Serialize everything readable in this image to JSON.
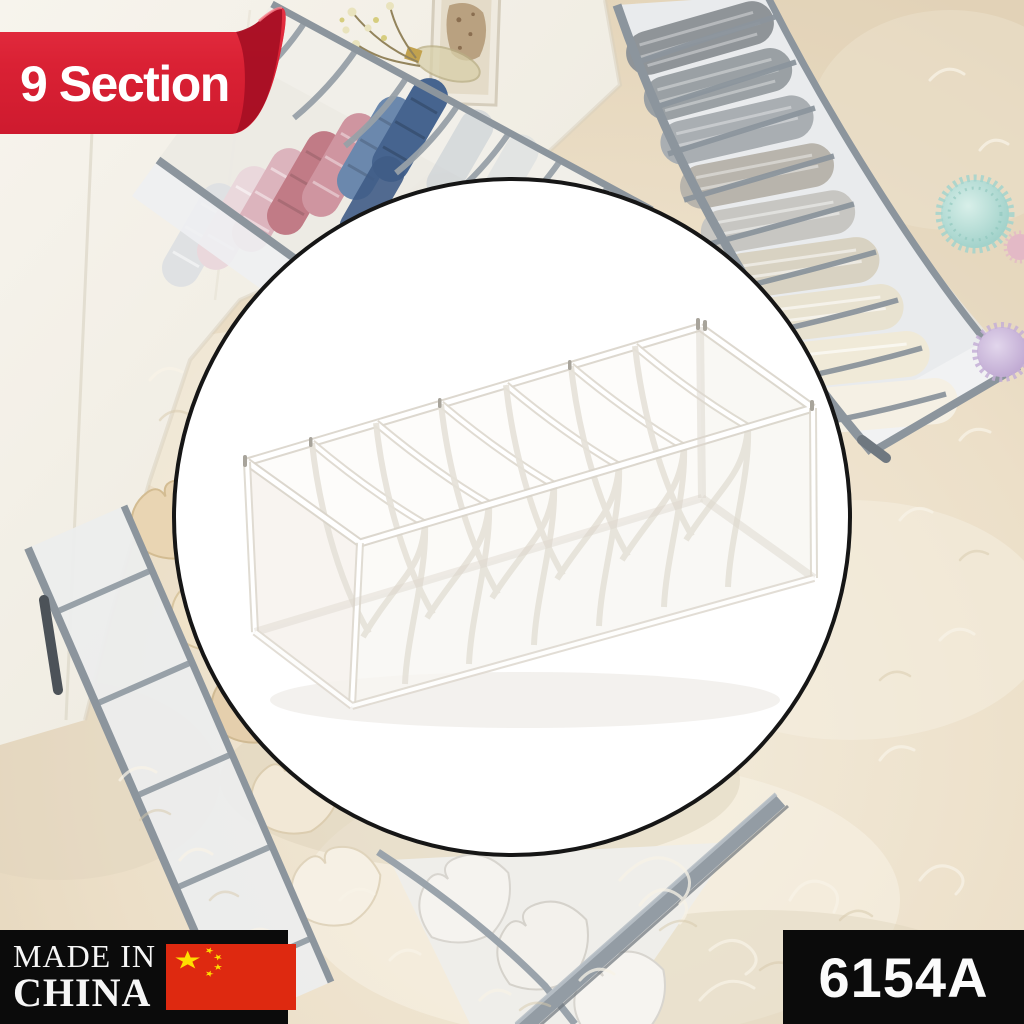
{
  "image_type": "e-commerce product photo",
  "banner": {
    "label": "9 Section",
    "text_color": "#ffffff",
    "ribbon_color": "#da2134",
    "ribbon_fold_color": "#a60f24"
  },
  "inset": {
    "shape": "circle",
    "background": "#ffffff",
    "border_color": "#161616",
    "product_name": "white-mesh-drawer-organizer",
    "compartments_visible": 7,
    "tape_color": "#f2efe9"
  },
  "made_in_badge": {
    "line1": "MADE IN",
    "line2": "CHINA",
    "background": "#0b0b0b",
    "text_color": "#f6f6f6",
    "flag": {
      "name": "china-flag",
      "field": "#de2910",
      "stars": "#ffde00"
    }
  },
  "code_badge": {
    "label": "6154A",
    "background": "#0b0b0b",
    "text_color": "#fbfbfb"
  },
  "scene": {
    "rug_color": "#ecdfc8",
    "wall_color": "#f4f1e9",
    "trim_color": "#8c959d",
    "items": [
      {
        "name": "drawer-organizer-with-rolled-clothes",
        "position": "top-left",
        "contents_colors": [
          "#dfe1e3",
          "#ead8dc",
          "#dcb4bd",
          "#c17b86",
          "#cf95a0",
          "#6b88ad",
          "#46648f"
        ]
      },
      {
        "name": "drawer-organizer-with-folded-clothes",
        "position": "top-right",
        "contents_colors": [
          "#8f9498",
          "#9aa0a4",
          "#a9aeb2",
          "#b8b4ac",
          "#c7c6c2",
          "#d8d2c2",
          "#e8e2d0",
          "#f0ead8",
          "#f5f0e4"
        ]
      },
      {
        "name": "drawer-organizer-with-beige-bras",
        "position": "bottom-left",
        "contents_colors": [
          "#e9d5b3",
          "#f0e3c9",
          "#e5cfad",
          "#f2e8d6",
          "#f6f0e4"
        ]
      },
      {
        "name": "drawer-organizer-with-white-bras",
        "position": "bottom-center",
        "contents_colors": [
          "#f5f3ef"
        ]
      },
      {
        "name": "pompom-flower-teal",
        "color": "#a2d4cc"
      },
      {
        "name": "pompom-flower-lavender",
        "color": "#c4afd6"
      },
      {
        "name": "pompom-flower-pink",
        "color": "#e3b9c6"
      },
      {
        "name": "dried-flower-sprig",
        "color": "#d9d08c"
      },
      {
        "name": "picture-frame",
        "color": "#b49a78"
      },
      {
        "name": "fur-rug",
        "color": "#ecdfc8"
      },
      {
        "name": "white-wall-and-furniture",
        "color": "#f4f1e9"
      }
    ]
  }
}
